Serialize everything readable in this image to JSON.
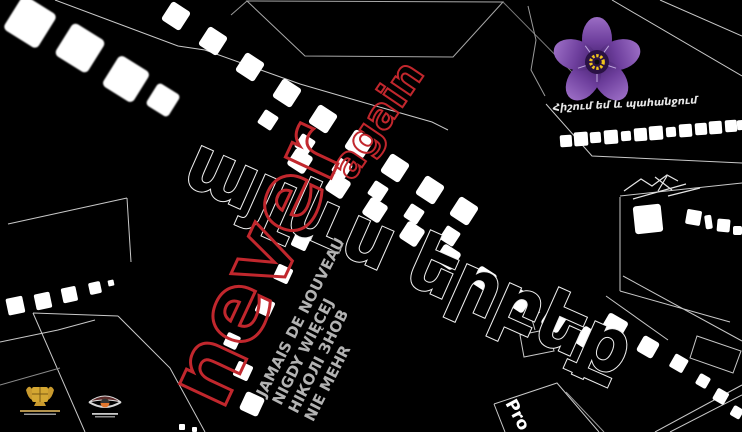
{
  "poster": {
    "background_color": "#000000",
    "title_armenian": "այլևս երբեք",
    "never_label": "never",
    "again_label": "again",
    "translations": [
      {
        "lang": "fr",
        "text": "JAMAIS DE NOUVEAU"
      },
      {
        "lang": "pl",
        "text": "NIGDY WIĘCEJ"
      },
      {
        "lang": "uk",
        "text": "НІКОЛІ ЗНОВ"
      },
      {
        "lang": "de",
        "text": "NIE MEHR"
      }
    ],
    "slogan_armenian": "Հիշում եմ և պահանջում",
    "credit_partial_text": "Pro",
    "icons": [
      "forget-me-not-flower",
      "armenia-coat-of-arms-logo",
      "golden-apricot-eye-logo",
      "film-strip"
    ],
    "colors": {
      "accent_red": "#c1272d",
      "translation_gray": "#b3b3b3",
      "film_white": "#ffffff",
      "outline_gray": "#c8c8c8",
      "flower_petal_purple": "#6e3f9d",
      "flower_center_purple": "#2a1244",
      "flower_ring_yellow": "#f0c41b"
    }
  }
}
